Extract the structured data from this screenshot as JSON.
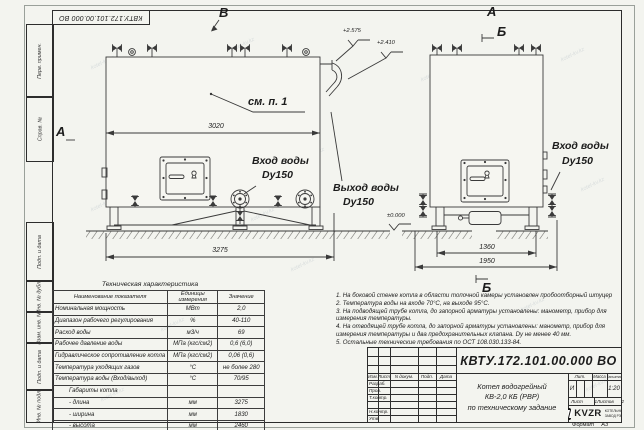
{
  "watermark": "kotel-kv.kz",
  "sheet": {
    "designation_flipped": "КВТУ.172.101.00.000 ВО",
    "side_columns": {
      "col1": "Перв. примен.",
      "col2": "Справ. №",
      "col3": "Подп. и дата",
      "col4": "Инв. № дубл.",
      "col5": "Взам. инв. №",
      "col6": "Подп. и дата",
      "col7": "Инв. № подл."
    },
    "format_label": "Формат",
    "format_value": "А3"
  },
  "front_view": {
    "marker_top": "В",
    "marker_left": "А",
    "callout": "см. п. 1",
    "dim_inner": "3020",
    "dim_overall": "3275",
    "elev_top": "+2.575",
    "elev_mid": "+2.410",
    "elev_zero": "±0.000",
    "inlet_title": "Вход воды",
    "inlet_size": "Dy150",
    "outlet_title": "Выход воды",
    "outlet_size": "Dy150"
  },
  "side_view": {
    "marker_top": "А",
    "marker_section_top": "Б",
    "marker_section_bottom": "Б",
    "dim_base": "1360",
    "dim_overall": "1950",
    "inlet_title": "Вход воды",
    "inlet_size": "Dy150"
  },
  "spec_table": {
    "title": "Техническая характеристика",
    "headers": [
      "Наименование показателя",
      "Единицы измерения",
      "Значение"
    ],
    "rows": [
      [
        "Номинальная мощность",
        "МВт",
        "2,0"
      ],
      [
        "Диапазон рабочего регулирования",
        "%",
        "40-110"
      ],
      [
        "Расход воды",
        "м3/ч",
        "69"
      ],
      [
        "Рабочее давление воды",
        "МПа (кгс/см2)",
        "0,6 (6,0)"
      ],
      [
        "Гидравлическое сопротивление котла",
        "МПа (кгс/см2)",
        "0,06 (0,6)"
      ],
      [
        "Температура уходящих газов",
        "°С",
        "не более 280"
      ],
      [
        "Температура воды (Вход/выход)",
        "°С",
        "70/95"
      ],
      [
        "Габариты котла",
        "",
        ""
      ],
      [
        "- длина",
        "мм",
        "3275"
      ],
      [
        "- ширина",
        "мм",
        "1830"
      ],
      [
        "- высота",
        "мм",
        "2460"
      ]
    ]
  },
  "notes": [
    "1.  На боковой стенке котла в области топочной камеры установлен пробоотборный штуцер",
    "2.  Температура воды на входе 70°С, на выходе 95°С.",
    "3.  На подводящей трубе котла, до запорной арматуры установлены: манометр, прибор для измерения температуры.",
    "4.  На отводящей трубе котла, до запорной арматуры установлены: манометр, прибор для измерения температуры и два предохранительных клапана. Dу не менее 40 мм.",
    "5.  Остальные технические требования по ОСТ 108.030.133-84."
  ],
  "title_block": {
    "designation": "КВТУ.172.101.00.000 ВО",
    "product_line1": "Котел водогрейный",
    "product_line2": "КВ-2,0 КБ (РВР)",
    "product_line3": "по техническому задание",
    "cols": {
      "izm": "Изм.",
      "list": "Лист",
      "ndoc": "N докум.",
      "podp": "Подп.",
      "data": "Дата"
    },
    "rows": {
      "r1": "Разраб.",
      "r2": "Пров.",
      "r3": "Т.контр.",
      "r4": "",
      "r5": "Н.контр.",
      "r6": "Утв."
    },
    "lit_label": "Лит.",
    "lit_value": "И",
    "mass_label": "Масса",
    "scale_label": "Масштаб",
    "scale_value": "1:20",
    "sheet_label": "Лист",
    "sheet_value": "1",
    "sheets_label": "Листов",
    "sheets_value": "2",
    "logo_text": "KVZR",
    "logo_line1": "КОТЕЛЬНЫЙ",
    "logo_line2": "ЗАВОД РЭП"
  }
}
